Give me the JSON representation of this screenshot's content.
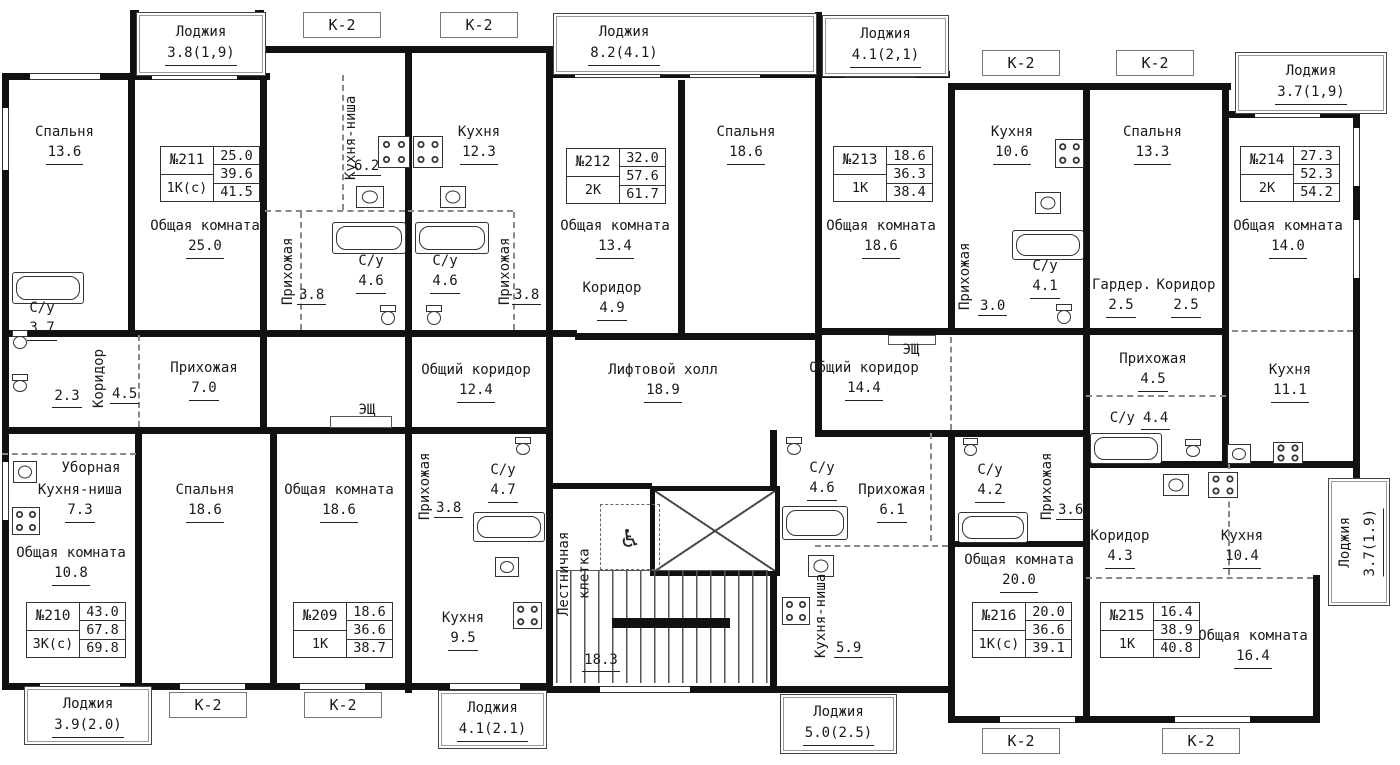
{
  "floor_plan": {
    "apartments": [
      {
        "number": "№211",
        "type": "1К(с)",
        "values": [
          "25.0",
          "39.6",
          "41.5"
        ],
        "x": 160,
        "y": 146
      },
      {
        "number": "№212",
        "type": "2К",
        "values": [
          "32.0",
          "57.6",
          "61.7"
        ],
        "x": 566,
        "y": 148
      },
      {
        "number": "№213",
        "type": "1К",
        "values": [
          "18.6",
          "36.3",
          "38.4"
        ],
        "x": 833,
        "y": 146
      },
      {
        "number": "№214",
        "type": "2К",
        "values": [
          "27.3",
          "52.3",
          "54.2"
        ],
        "x": 1240,
        "y": 146
      },
      {
        "number": "№210",
        "type": "3К(с)",
        "values": [
          "43.0",
          "67.8",
          "69.8"
        ],
        "x": 26,
        "y": 602
      },
      {
        "number": "№209",
        "type": "1К",
        "values": [
          "18.6",
          "36.6",
          "38.7"
        ],
        "x": 293,
        "y": 602
      },
      {
        "number": "№216",
        "type": "1К(с)",
        "values": [
          "20.0",
          "36.6",
          "39.1"
        ],
        "x": 972,
        "y": 602
      },
      {
        "number": "№215",
        "type": "1К",
        "values": [
          "16.4",
          "38.9",
          "40.8"
        ],
        "x": 1100,
        "y": 602
      }
    ],
    "balconies": [
      {
        "label": "Лоджия",
        "area": "3.8(1,9)",
        "x": 136,
        "y": 12,
        "w": 128,
        "h": 62
      },
      {
        "label": "Лоджия",
        "area": "8.2(4.1)",
        "x": 553,
        "y": 13,
        "w": 262,
        "h": 60,
        "lx": 10,
        "lw": 120
      },
      {
        "label": "Лоджия",
        "area": "4.1(2,1)",
        "x": 822,
        "y": 15,
        "w": 125,
        "h": 60
      },
      {
        "label": "Лоджия",
        "area": "3.7(1,9)",
        "x": 1235,
        "y": 52,
        "w": 150,
        "h": 60
      },
      {
        "label": "Лоджия",
        "area": "3.9(2.0)",
        "x": 24,
        "y": 686,
        "w": 126,
        "h": 57
      },
      {
        "label": "Лоджия",
        "area": "4.1(2.1)",
        "x": 438,
        "y": 690,
        "w": 107,
        "h": 57
      },
      {
        "label": "Лоджия",
        "area": "5.0(2.5)",
        "x": 780,
        "y": 694,
        "w": 115,
        "h": 58
      },
      {
        "label": "Лоджия",
        "area": "3.7(1.9)",
        "x": 1328,
        "y": 478,
        "w": 60,
        "h": 126,
        "vertical": true
      }
    ],
    "k2_labels": [
      {
        "label": "К-2",
        "x": 303,
        "y": 12
      },
      {
        "label": "К-2",
        "x": 440,
        "y": 12
      },
      {
        "label": "К-2",
        "x": 982,
        "y": 50
      },
      {
        "label": "К-2",
        "x": 1116,
        "y": 50
      },
      {
        "label": "К-2",
        "x": 169,
        "y": 692
      },
      {
        "label": "К-2",
        "x": 304,
        "y": 692
      },
      {
        "label": "К-2",
        "x": 982,
        "y": 728
      },
      {
        "label": "К-2",
        "x": 1162,
        "y": 728
      }
    ],
    "rooms": [
      {
        "name": "Спальня",
        "area": "13.6",
        "x": 22,
        "y": 122,
        "w": 85
      },
      {
        "name": "Общая комната",
        "area": "25.0",
        "x": 148,
        "y": 216,
        "w": 114
      },
      {
        "name": "Кухня-ниша",
        "area": "6.2",
        "x": 340,
        "y": 95,
        "vertical": true,
        "len": 85,
        "ax": 352,
        "ay": 158
      },
      {
        "name": "Кухня",
        "area": "12.3",
        "x": 445,
        "y": 122,
        "w": 68
      },
      {
        "name": "Прихожая",
        "area": "3.8",
        "x": 277,
        "y": 236,
        "vertical": true,
        "len": 70,
        "ax": 297,
        "ay": 287
      },
      {
        "name": "С/у",
        "area": "4.6",
        "x": 346,
        "y": 251,
        "w": 50
      },
      {
        "name": "С/у",
        "area": "4.6",
        "x": 420,
        "y": 251,
        "w": 50
      },
      {
        "name": "Прихожая",
        "area": "3.8",
        "x": 494,
        "y": 236,
        "vertical": true,
        "len": 70,
        "ax": 512,
        "ay": 287
      },
      {
        "name": "Общая комната",
        "area": "13.4",
        "x": 558,
        "y": 216,
        "w": 114
      },
      {
        "name": "Коридор",
        "area": "4.9",
        "x": 578,
        "y": 278,
        "w": 68
      },
      {
        "name": "Спальня",
        "area": "18.6",
        "x": 706,
        "y": 122,
        "w": 80
      },
      {
        "name": "Общая комната",
        "area": "18.6",
        "x": 824,
        "y": 216,
        "w": 114
      },
      {
        "name": "Кухня",
        "area": "10.6",
        "x": 978,
        "y": 122,
        "w": 68
      },
      {
        "name": "Прихожая",
        "area": "3.0",
        "x": 954,
        "y": 240,
        "vertical": true,
        "len": 72,
        "ax": 978,
        "ay": 298
      },
      {
        "name": "С/у",
        "area": "4.1",
        "x": 1022,
        "y": 256,
        "w": 46
      },
      {
        "name": "Гардер.",
        "area": "2.5",
        "x": 1092,
        "y": 275,
        "w": 58
      },
      {
        "name": "Коридор",
        "area": "2.5",
        "x": 1155,
        "y": 275,
        "w": 62
      },
      {
        "name": "Спальня",
        "area": "13.3",
        "x": 1115,
        "y": 122,
        "w": 75
      },
      {
        "name": "Общая комната",
        "area": "14.0",
        "x": 1232,
        "y": 216,
        "w": 112
      },
      {
        "name": "С/у",
        "area": "3.7",
        "x": 20,
        "y": 298,
        "w": 44
      },
      {
        "name": "Коридор",
        "area": "4.5",
        "x": 88,
        "y": 347,
        "vertical": true,
        "len": 62,
        "ax": 110,
        "ay": 386
      },
      {
        "name": "",
        "area": "2.3",
        "x": 50,
        "y": 386,
        "w": 34
      },
      {
        "name": "Уборная",
        "area": "",
        "x": 58,
        "y": 458,
        "w": 66
      },
      {
        "name": "Прихожая",
        "area": "7.0",
        "x": 166,
        "y": 358,
        "w": 76
      },
      {
        "name": "Общий коридор",
        "area": "12.4",
        "x": 420,
        "y": 360,
        "w": 112
      },
      {
        "name": "ЭЩ",
        "area": "",
        "x": 350,
        "y": 400,
        "w": 34
      },
      {
        "name": "Лифтовой холл",
        "area": "18.9",
        "x": 606,
        "y": 360,
        "w": 114
      },
      {
        "name": "Общий коридор",
        "area": "14.4",
        "x": 808,
        "y": 358,
        "w": 112
      },
      {
        "name": "ЭЩ",
        "area": "",
        "x": 894,
        "y": 340,
        "w": 34
      },
      {
        "name": "Прихожая",
        "area": "4.5",
        "x": 1116,
        "y": 349,
        "w": 74
      },
      {
        "name": "С/у",
        "area": "4.4",
        "x": 1106,
        "y": 408,
        "w": 68,
        "inline": true
      },
      {
        "name": "Кухня",
        "area": "11.1",
        "x": 1256,
        "y": 360,
        "w": 68
      },
      {
        "name": "Кухня-ниша",
        "area": "7.3",
        "x": 28,
        "y": 480,
        "w": 104
      },
      {
        "name": "Общая комната",
        "area": "10.8",
        "x": 14,
        "y": 543,
        "w": 114
      },
      {
        "name": "Спальня",
        "area": "18.6",
        "x": 165,
        "y": 480,
        "w": 80
      },
      {
        "name": "Общая комната",
        "area": "18.6",
        "x": 282,
        "y": 480,
        "w": 114
      },
      {
        "name": "Прихожая",
        "area": "3.8",
        "x": 414,
        "y": 452,
        "vertical": true,
        "len": 68,
        "ax": 434,
        "ay": 500
      },
      {
        "name": "С/у",
        "area": "4.7",
        "x": 480,
        "y": 460,
        "w": 46
      },
      {
        "name": "Кухня",
        "area": "9.5",
        "x": 430,
        "y": 608,
        "w": 66
      },
      {
        "name": "Лестничная клетка",
        "area": "",
        "x": 552,
        "y": 524,
        "vertical": true,
        "len": 100,
        "vw": 44
      },
      {
        "name": "",
        "area": "18.3",
        "x": 580,
        "y": 650,
        "w": 42
      },
      {
        "name": "С/у",
        "area": "4.6",
        "x": 798,
        "y": 458,
        "w": 48
      },
      {
        "name": "Прихожая",
        "area": "6.1",
        "x": 854,
        "y": 480,
        "w": 76
      },
      {
        "name": "Кухня-ниша",
        "area": "5.9",
        "x": 810,
        "y": 572,
        "vertical": true,
        "len": 88,
        "ax": 834,
        "ay": 640
      },
      {
        "name": "С/у",
        "area": "4.2",
        "x": 966,
        "y": 460,
        "w": 48
      },
      {
        "name": "Прихожая",
        "area": "3.6",
        "x": 1036,
        "y": 452,
        "vertical": true,
        "len": 68,
        "ax": 1056,
        "ay": 502
      },
      {
        "name": "Общая комната",
        "area": "20.0",
        "x": 962,
        "y": 550,
        "w": 114
      },
      {
        "name": "Коридор",
        "area": "4.3",
        "x": 1088,
        "y": 526,
        "w": 64
      },
      {
        "name": "Кухня",
        "area": "10.4",
        "x": 1210,
        "y": 526,
        "w": 64
      },
      {
        "name": "Общая комната",
        "area": "16.4",
        "x": 1196,
        "y": 626,
        "w": 114
      }
    ]
  }
}
